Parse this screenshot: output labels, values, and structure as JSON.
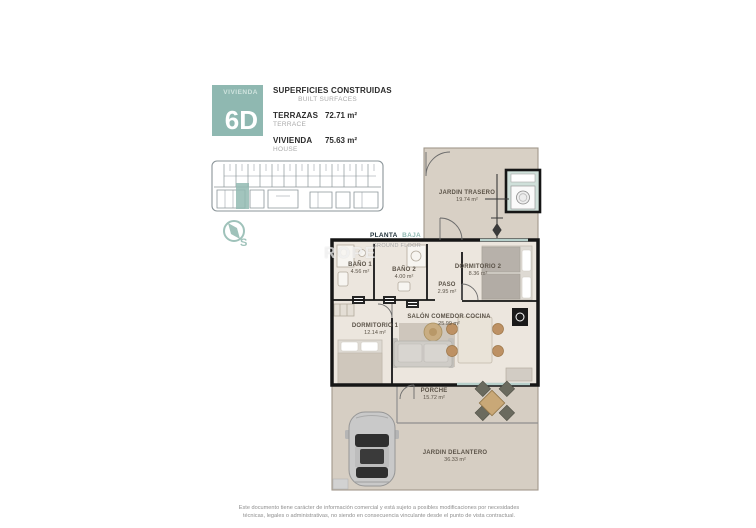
{
  "header": {
    "unit_label": "VIVIENDA",
    "unit_number": "6D",
    "title": "SUPERFICIES CONSTRUIDAS",
    "title_en": "BUILT SURFACES",
    "rows": [
      {
        "label": "TERRAZAS",
        "label_en": "TERRACE",
        "value": "72.71 m²"
      },
      {
        "label": "VIVIENDA",
        "label_en": "HOUSE",
        "value": "75.63 m²"
      }
    ]
  },
  "floor_label": {
    "main": "PLANTA",
    "accent": "BAJA",
    "sub": "GROUND FLOOR"
  },
  "compass": {
    "label": "S"
  },
  "watermark": "ROPE",
  "rooms": [
    {
      "name": "JARDIN TRASERO",
      "area": "19.74 m²"
    },
    {
      "name": "DORMITORIO 2",
      "area": "8.36 m²"
    },
    {
      "name": "BAÑO 1",
      "area": "4.56 m²"
    },
    {
      "name": "BAÑO 2",
      "area": "4.00 m²"
    },
    {
      "name": "PASO",
      "area": "2.95 m²"
    },
    {
      "name": "DORMITORIO 1",
      "area": "12.14 m²"
    },
    {
      "name": "SALÓN COMEDOR COCINA",
      "area": "25.99 m²"
    },
    {
      "name": "PORCHE",
      "area": "15.72 m²"
    },
    {
      "name": "JARDIN DELANTERO",
      "area": "36.33 m²"
    }
  ],
  "disclaimer": "Este documento tiene carácter de información comercial y está sujeto a posibles modificaciones por necesidades técnicas, legales o administrativas, no siendo en consecuencia vinculante desde el punto de vista contractual.",
  "colors": {
    "accent": "#8fb8b1",
    "terrace": "#d8d0c5",
    "interior": "#ece6de",
    "wall": "#161616"
  }
}
